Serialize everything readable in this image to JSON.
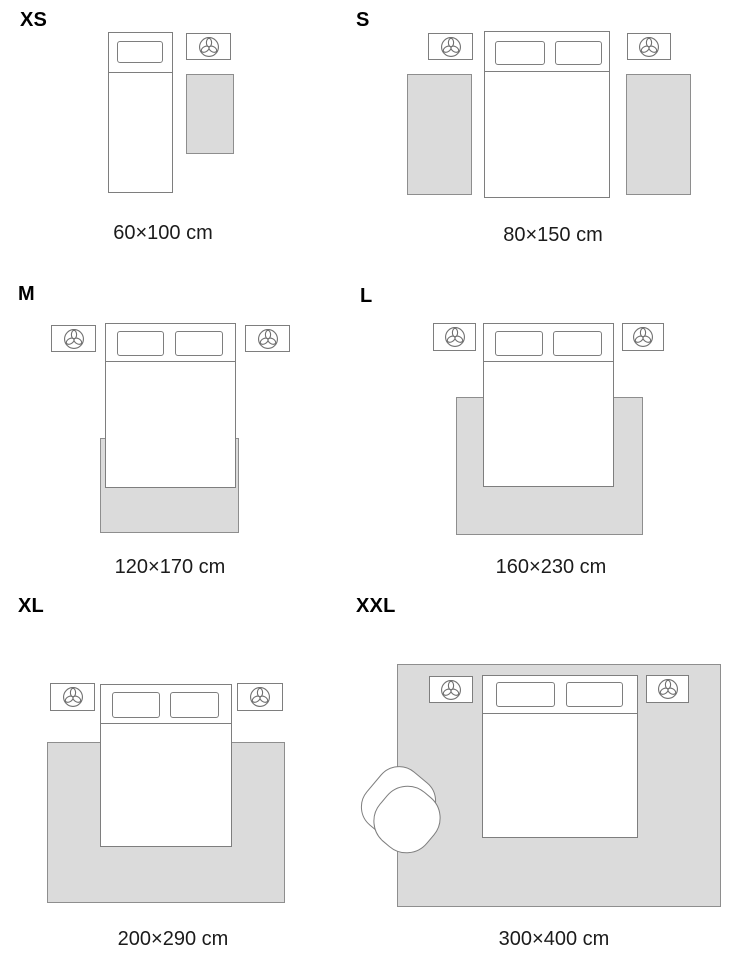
{
  "title": "Rug size guide with bedroom layouts",
  "colors": {
    "outline": "#7e7e7e",
    "rug_border": "#8e8e8e",
    "rug_fill": "#dbdbdb",
    "caption_text": "#1b1b1b",
    "label_text": "#000000"
  },
  "icons": {
    "nightstand": "plant-icon"
  },
  "sections": [
    {
      "id": "xs",
      "label": "XS",
      "dimension": "60×100 cm",
      "layout": "runner beside single bed"
    },
    {
      "id": "s",
      "label": "S",
      "dimension": "80×150 cm",
      "layout": "two runners beside double bed"
    },
    {
      "id": "m",
      "label": "M",
      "dimension": "120×170 cm",
      "layout": "rug under foot of bed"
    },
    {
      "id": "l",
      "label": "L",
      "dimension": "160×230 cm",
      "layout": "rug under lower bed, wider than bed"
    },
    {
      "id": "xl",
      "label": "XL",
      "dimension": "200×290 cm",
      "layout": "large rug under lower bed"
    },
    {
      "id": "xxl",
      "label": "XXL",
      "dimension": "300×400 cm",
      "layout": "room-size rug under bed, nightstands and armchair"
    }
  ]
}
